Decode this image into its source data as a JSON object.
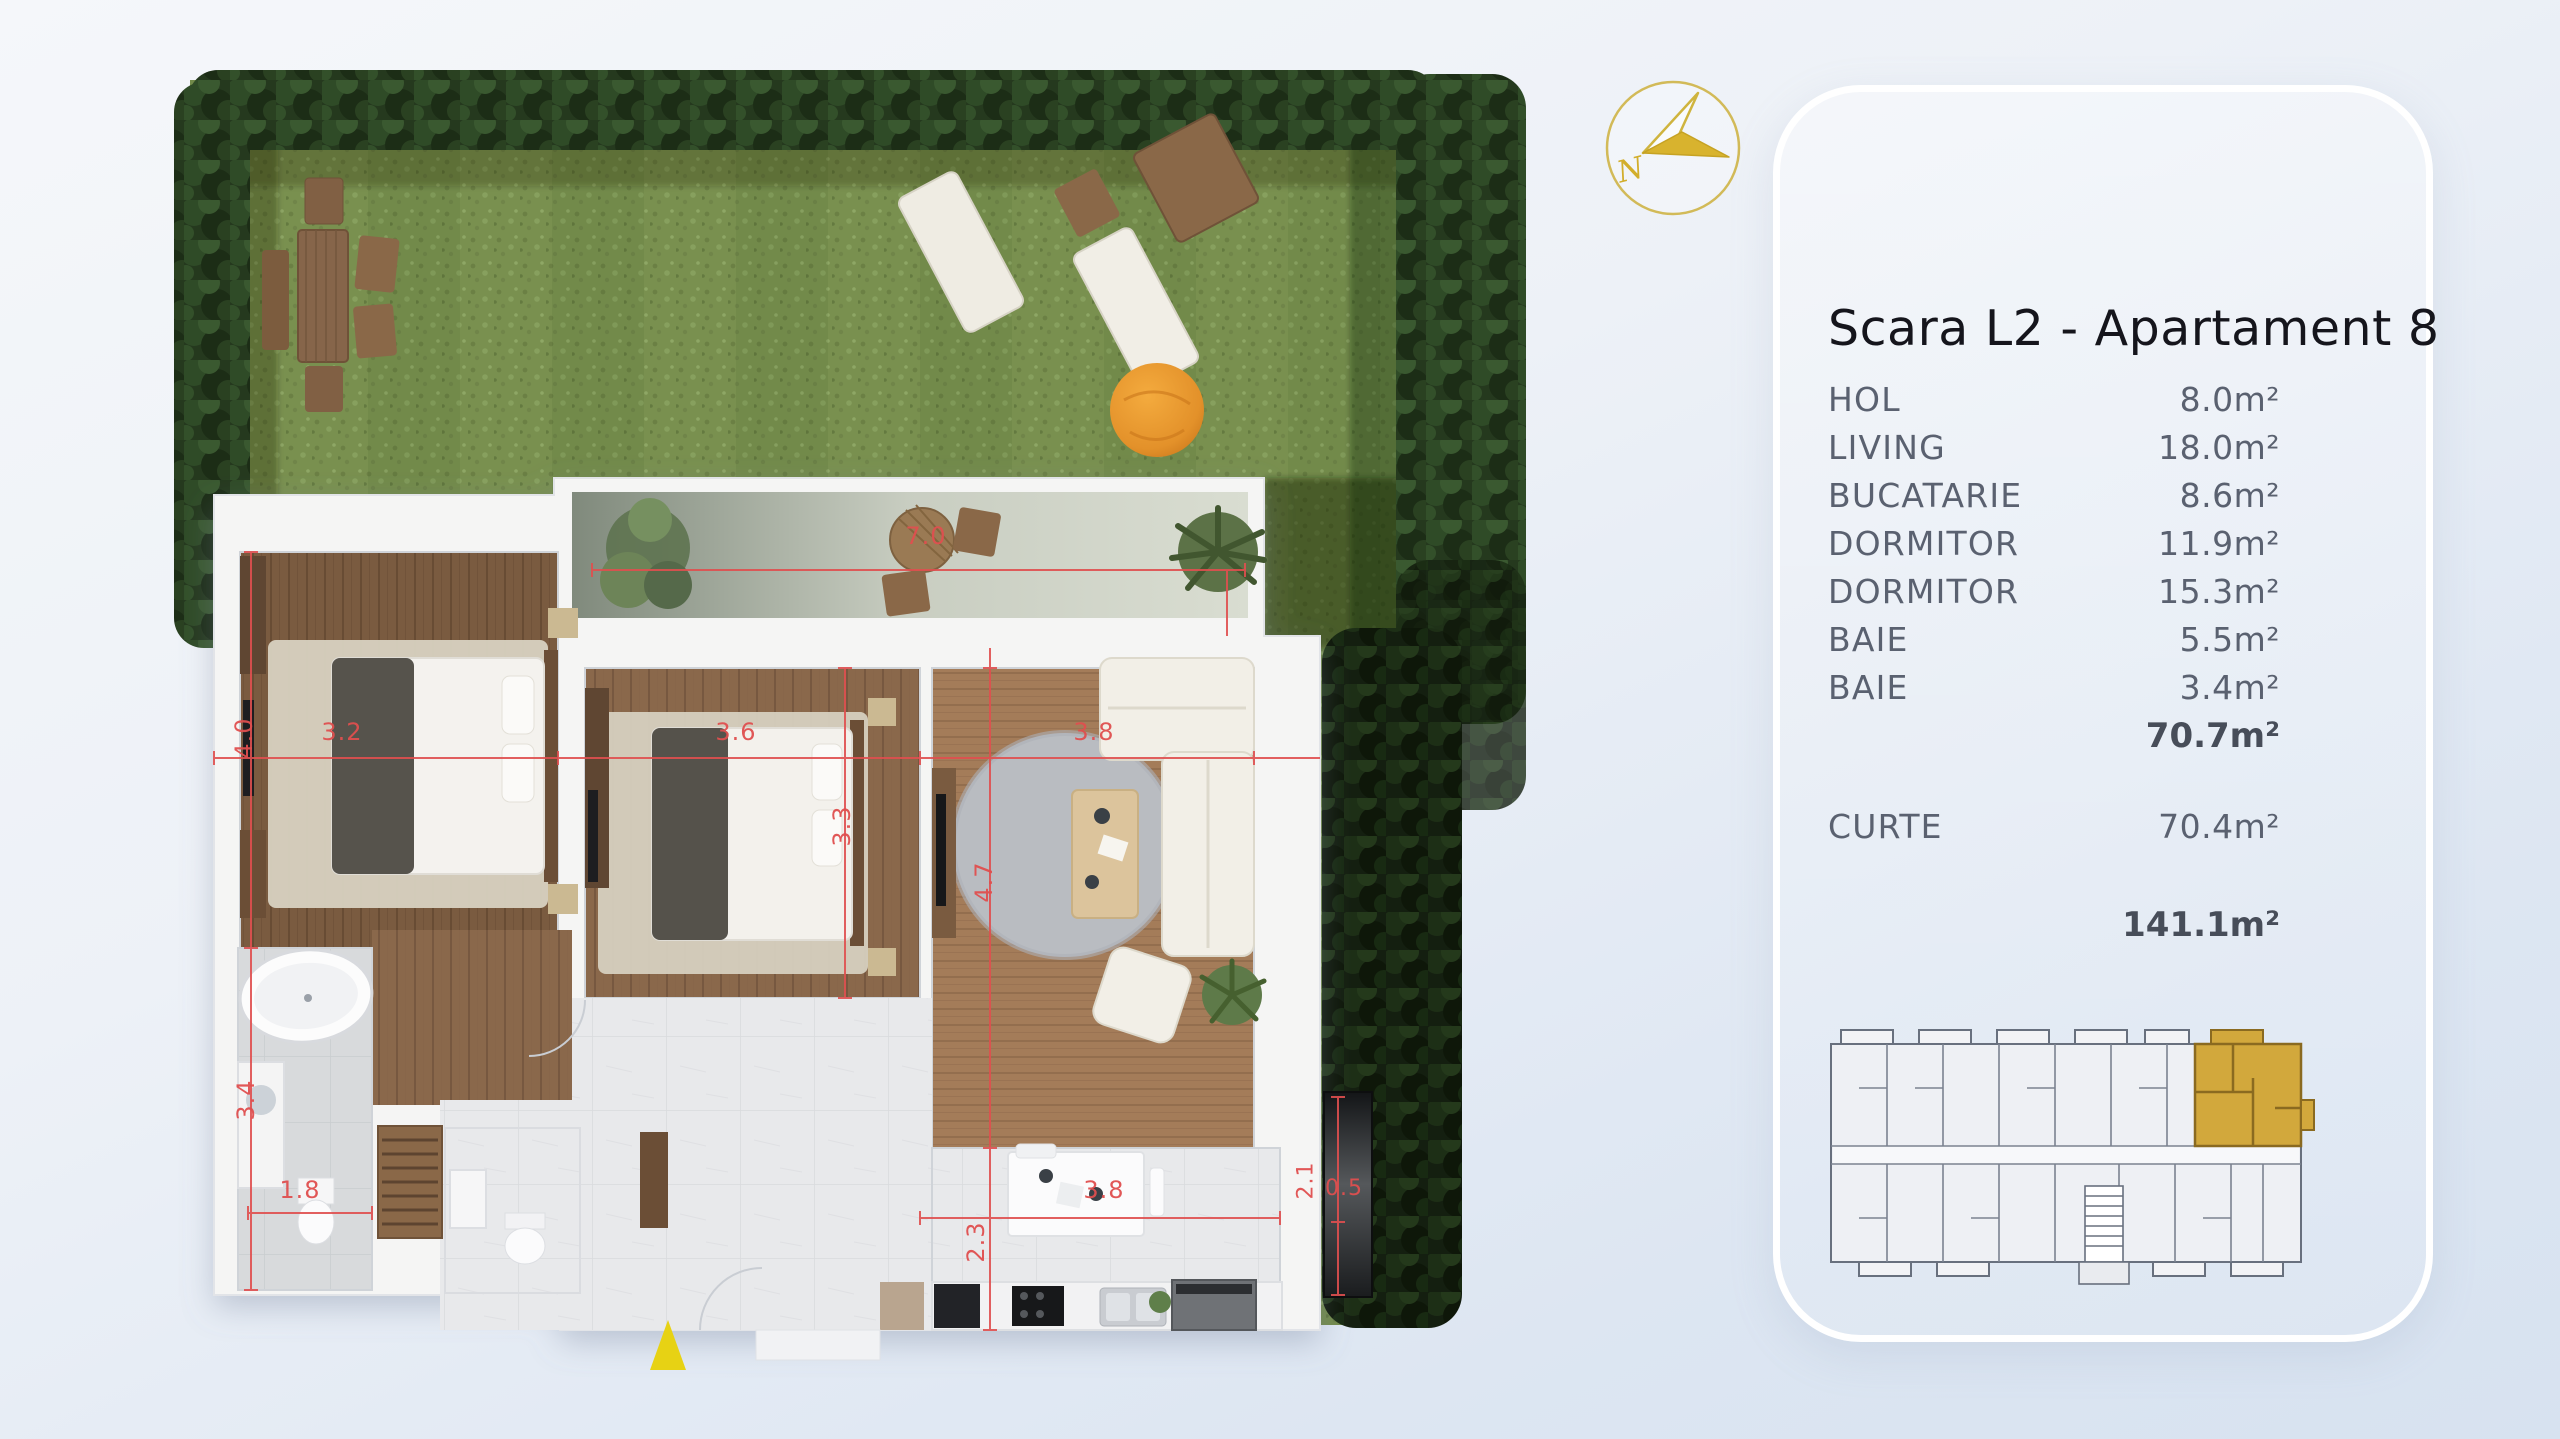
{
  "panel": {
    "title": "Scara L2 - Apartament 8",
    "rooms": [
      {
        "label": "HOL",
        "area": "8.0m²"
      },
      {
        "label": "LIVING",
        "area": "18.0m²"
      },
      {
        "label": "BUCATARIE",
        "area": "8.6m²"
      },
      {
        "label": "DORMITOR",
        "area": "11.9m²"
      },
      {
        "label": "DORMITOR",
        "area": "15.3m²"
      },
      {
        "label": "BAIE",
        "area": "5.5m²"
      },
      {
        "label": "BAIE",
        "area": "3.4m²"
      }
    ],
    "interior_total": "70.7m²",
    "curte": {
      "label": "CURTE",
      "area": "70.4m²"
    },
    "grand_total": "141.1m²"
  },
  "compass": {
    "letter": "N",
    "color": "#d2ba58"
  },
  "plan": {
    "dim_color": "#e04f4f",
    "entrance_marker_color": "#e7d214",
    "dims": {
      "terrace_w": "7.0",
      "bedroom1_h": "4.0",
      "bedroom1_w": "3.2",
      "bedroom2_w": "3.6",
      "bedroom2_h": "3.3",
      "living_w": "3.8",
      "living_h": "4.7",
      "bath1_h": "3.4",
      "bath1_w": "1.8",
      "kitchen_w": "3.8",
      "kitchen_h": "2.3",
      "side_h": "2.1",
      "side_w": "0.5"
    }
  },
  "minimap": {
    "highlight_color": "#d2a83c"
  }
}
